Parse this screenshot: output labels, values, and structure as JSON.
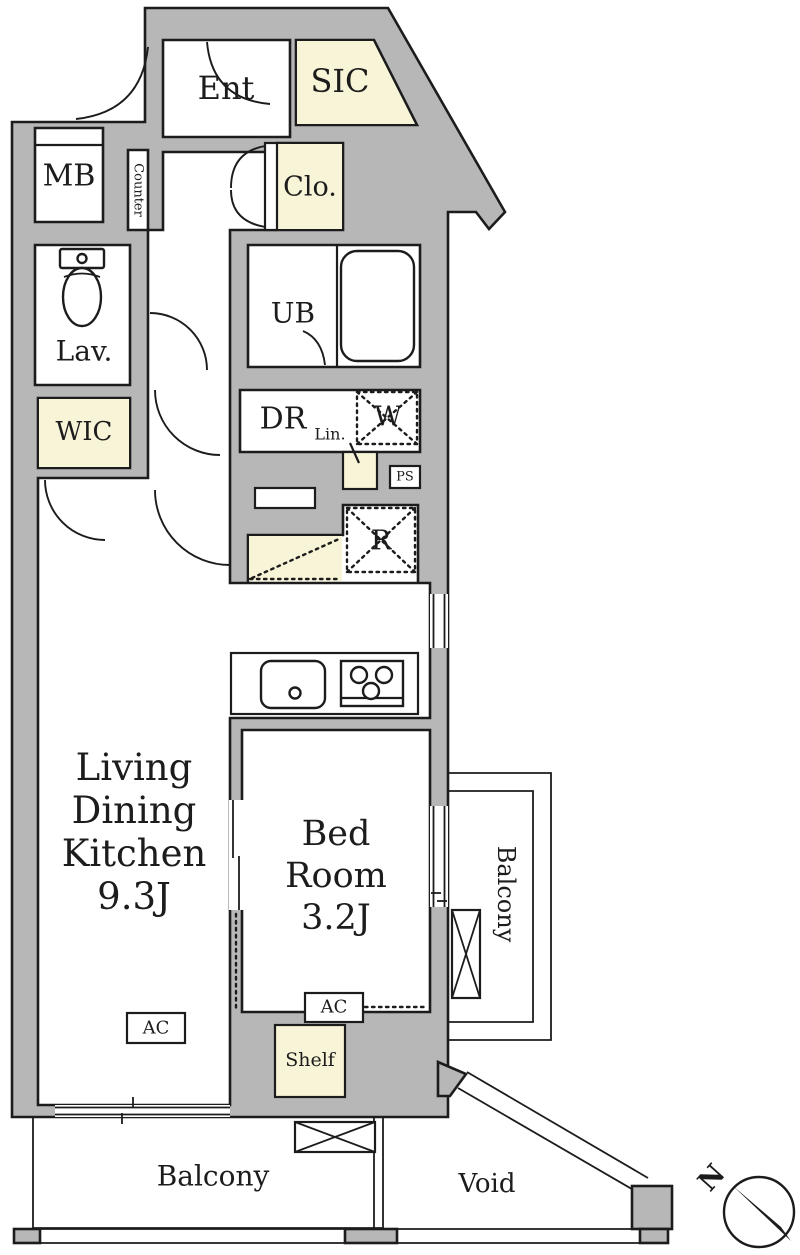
{
  "title": "Apartment floor plan 1K",
  "colors": {
    "wall": "#b7b7b7",
    "cream": "#f8f4d8",
    "line": "#1c1c1c",
    "bg": "#ffffff"
  },
  "rooms": {
    "entrance": {
      "label": "Ent"
    },
    "shoe_closet": {
      "label": "SIC"
    },
    "meter_box": {
      "label": "MB"
    },
    "counter": {
      "label": "Counter"
    },
    "closet": {
      "label": "Clo."
    },
    "lavatory": {
      "label": "Lav."
    },
    "unit_bath": {
      "label": "UB"
    },
    "dressing_room": {
      "label": "DR"
    },
    "linen": {
      "label": "Lin."
    },
    "washer_space": {
      "label": "W"
    },
    "pipe_space": {
      "label": "PS"
    },
    "refrigerator_space": {
      "label": "R"
    },
    "walk_in_closet": {
      "label": "WIC"
    },
    "living_dining_kitchen": {
      "line1": "Living",
      "line2": "Dining",
      "line3": "Kitchen",
      "size": "9.3J"
    },
    "bedroom": {
      "line1": "Bed",
      "line2": "Room",
      "size": "3.2J"
    },
    "shelf": {
      "label": "Shelf"
    },
    "balcony_side": {
      "label": "Balcony"
    },
    "balcony_bottom": {
      "label": "Balcony"
    },
    "void": {
      "label": "Void"
    }
  },
  "equipment": {
    "ac_living": "AC",
    "ac_bedroom": "AC"
  },
  "compass": {
    "north": "N"
  }
}
